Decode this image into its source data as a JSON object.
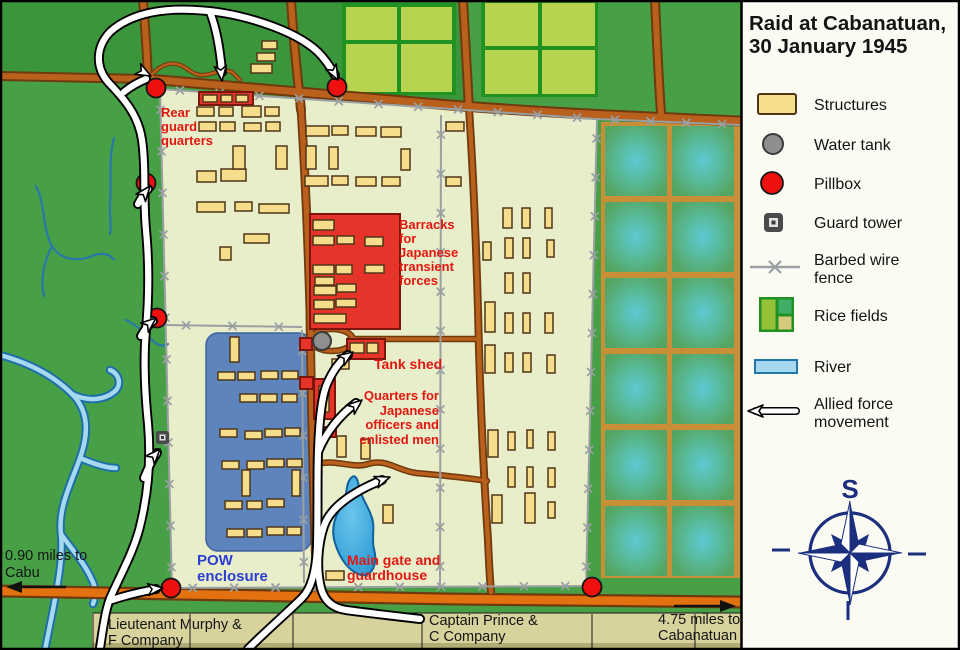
{
  "title": {
    "line1": "Raid at Cabanatuan,",
    "line2": "30 January 1945"
  },
  "legend": {
    "items": [
      {
        "id": "structures",
        "label": "Structures"
      },
      {
        "id": "water-tank",
        "label": "Water tank"
      },
      {
        "id": "pillbox",
        "label": "Pillbox"
      },
      {
        "id": "guard-tower",
        "label": "Guard tower"
      },
      {
        "id": "barbed-wire-fence",
        "label1": "Barbed wire",
        "label2": "fence"
      },
      {
        "id": "rice-fields",
        "label": "Rice fields"
      },
      {
        "id": "river",
        "label": "River"
      },
      {
        "id": "allied-force-movement",
        "label1": "Allied force",
        "label2": "movement"
      }
    ]
  },
  "compass": {
    "label": "S"
  },
  "map_labels": {
    "rear_guard": [
      "Rear",
      "guard",
      "quarters"
    ],
    "barracks": [
      "Barracks",
      "for",
      "Japanese",
      "transient",
      "forces"
    ],
    "tank_shed": "Tank shed",
    "quarters": [
      "Quarters for",
      "Japanese",
      "officers and",
      "enlisted men"
    ],
    "pow": [
      "POW",
      "enclosure"
    ],
    "main_gate": [
      "Main gate and",
      "guardhouse"
    ],
    "cabu": [
      "0.90 miles to",
      "Cabu"
    ],
    "murphy": [
      "Lieutenant Murphy &",
      "F Company"
    ],
    "prince": [
      "Captain Prince &",
      "C Company"
    ],
    "cabanatuan": [
      "4.75 miles to",
      "Cabanatuan"
    ]
  },
  "colors": {
    "land": "#47a046",
    "land_dark": "#3b963b",
    "camp": "#e8edca",
    "pow": "#5d84bc",
    "pow_dark": "#3f639c",
    "road": "#b8601c",
    "road_dark": "#6f3a0e",
    "road_bottom": "#e4710f",
    "structure": "#f6dd8b",
    "structure_border": "#4f3617",
    "red_building": "#e6342a",
    "pillbox": "#ee0f0f",
    "water_tank": "#8f8f8f",
    "fence": "#9aa0a2",
    "river": "#a6d9ef",
    "river_dark": "#1d6fa8",
    "stream": "#2878a8",
    "pond": "#2d9bd6",
    "pond_dark": "#10629f",
    "rice_cell": "#b7d450",
    "rice_border": "#1f9222",
    "paddy_line": "#c98f37",
    "paddy_green": "#55a562",
    "paddy_teal": "#5dc9d3",
    "band": "#d8d29c",
    "band_dark": "#b2ac74",
    "panel": "#fbfbf4",
    "text_red": "#e21711",
    "text_blue": "#2b3ed2",
    "ink": "#141414",
    "navy": "#1b2f7e"
  },
  "map_features": {
    "yellow_buildings": [
      [
        262,
        41,
        15,
        8
      ],
      [
        257,
        53,
        18,
        8
      ],
      [
        251,
        64,
        21,
        9
      ],
      [
        197,
        107,
        17,
        9
      ],
      [
        219,
        107,
        14,
        9
      ],
      [
        242,
        106,
        19,
        11
      ],
      [
        265,
        107,
        14,
        9
      ],
      [
        199,
        122,
        17,
        9
      ],
      [
        220,
        122,
        15,
        9
      ],
      [
        244,
        123,
        17,
        8
      ],
      [
        266,
        122,
        14,
        9
      ],
      [
        197,
        171,
        19,
        11
      ],
      [
        221,
        169,
        25,
        12
      ],
      [
        233,
        146,
        12,
        23
      ],
      [
        276,
        146,
        11,
        23
      ],
      [
        197,
        202,
        28,
        10
      ],
      [
        235,
        202,
        17,
        9
      ],
      [
        259,
        204,
        30,
        9
      ],
      [
        244,
        234,
        25,
        9
      ],
      [
        220,
        247,
        11,
        13
      ],
      [
        306,
        126,
        23,
        10
      ],
      [
        332,
        126,
        16,
        9
      ],
      [
        356,
        127,
        20,
        9
      ],
      [
        381,
        127,
        20,
        10
      ],
      [
        306,
        146,
        10,
        23
      ],
      [
        329,
        147,
        9,
        22
      ],
      [
        401,
        149,
        9,
        21
      ],
      [
        305,
        176,
        23,
        10
      ],
      [
        332,
        176,
        16,
        9
      ],
      [
        356,
        177,
        20,
        9
      ],
      [
        382,
        177,
        18,
        9
      ],
      [
        446,
        122,
        18,
        9
      ],
      [
        446,
        177,
        15,
        9
      ],
      [
        203,
        95,
        14,
        7
      ],
      [
        221,
        95,
        11,
        7
      ],
      [
        236,
        95,
        12,
        7
      ],
      [
        313,
        220,
        21,
        10
      ],
      [
        313,
        236,
        21,
        9
      ],
      [
        337,
        236,
        17,
        8
      ],
      [
        365,
        237,
        18,
        9
      ],
      [
        313,
        265,
        21,
        9
      ],
      [
        336,
        265,
        16,
        9
      ],
      [
        365,
        265,
        19,
        8
      ],
      [
        315,
        277,
        19,
        8
      ],
      [
        314,
        286,
        22,
        9
      ],
      [
        337,
        284,
        19,
        8
      ],
      [
        314,
        300,
        20,
        9
      ],
      [
        336,
        299,
        20,
        8
      ],
      [
        314,
        314,
        32,
        9
      ],
      [
        350,
        343,
        14,
        10
      ],
      [
        367,
        343,
        11,
        10
      ],
      [
        332,
        359,
        17,
        10
      ],
      [
        337,
        436,
        9,
        21
      ],
      [
        361,
        439,
        9,
        20
      ],
      [
        319,
        386,
        10,
        26
      ],
      [
        321,
        430,
        9,
        5
      ],
      [
        326,
        571,
        18,
        9
      ],
      [
        383,
        505,
        10,
        18
      ],
      [
        230,
        337,
        9,
        25
      ],
      [
        218,
        372,
        17,
        8
      ],
      [
        238,
        372,
        17,
        8
      ],
      [
        261,
        371,
        17,
        8
      ],
      [
        282,
        371,
        16,
        8
      ],
      [
        240,
        394,
        17,
        8
      ],
      [
        260,
        394,
        17,
        8
      ],
      [
        282,
        394,
        15,
        8
      ],
      [
        220,
        429,
        17,
        8
      ],
      [
        245,
        431,
        17,
        8
      ],
      [
        265,
        429,
        17,
        8
      ],
      [
        285,
        428,
        15,
        8
      ],
      [
        222,
        461,
        17,
        8
      ],
      [
        247,
        461,
        17,
        8
      ],
      [
        267,
        459,
        17,
        8
      ],
      [
        287,
        459,
        15,
        8
      ],
      [
        242,
        470,
        8,
        26
      ],
      [
        292,
        470,
        8,
        26
      ],
      [
        225,
        501,
        17,
        8
      ],
      [
        247,
        501,
        15,
        8
      ],
      [
        267,
        499,
        17,
        8
      ],
      [
        227,
        529,
        17,
        8
      ],
      [
        247,
        529,
        15,
        8
      ],
      [
        267,
        527,
        17,
        8
      ],
      [
        287,
        527,
        14,
        8
      ],
      [
        503,
        208,
        9,
        20
      ],
      [
        522,
        208,
        8,
        20
      ],
      [
        545,
        208,
        7,
        20
      ],
      [
        483,
        242,
        8,
        18
      ],
      [
        505,
        238,
        8,
        20
      ],
      [
        523,
        238,
        7,
        20
      ],
      [
        547,
        240,
        7,
        17
      ],
      [
        505,
        273,
        8,
        20
      ],
      [
        523,
        273,
        7,
        20
      ],
      [
        485,
        302,
        10,
        30
      ],
      [
        505,
        313,
        8,
        20
      ],
      [
        523,
        313,
        7,
        20
      ],
      [
        545,
        313,
        8,
        20
      ],
      [
        485,
        345,
        10,
        28
      ],
      [
        505,
        353,
        8,
        19
      ],
      [
        523,
        353,
        8,
        19
      ],
      [
        547,
        355,
        8,
        18
      ],
      [
        488,
        430,
        10,
        27
      ],
      [
        508,
        432,
        7,
        18
      ],
      [
        527,
        430,
        6,
        18
      ],
      [
        548,
        432,
        7,
        18
      ],
      [
        508,
        467,
        7,
        20
      ],
      [
        527,
        467,
        6,
        20
      ],
      [
        548,
        468,
        7,
        19
      ],
      [
        492,
        495,
        10,
        28
      ],
      [
        525,
        493,
        10,
        30
      ],
      [
        548,
        502,
        7,
        16
      ]
    ],
    "red_buildings": [
      [
        199,
        92,
        54,
        13
      ],
      [
        310,
        214,
        90,
        115
      ],
      [
        347,
        339,
        38,
        20
      ],
      [
        314,
        379,
        21,
        40
      ],
      [
        317,
        427,
        19,
        10
      ],
      [
        300,
        377,
        13,
        12
      ],
      [
        300,
        338,
        12,
        12
      ]
    ],
    "pillboxes": [
      [
        156,
        88
      ],
      [
        337,
        87
      ],
      [
        146,
        183
      ],
      [
        157,
        318
      ],
      [
        171,
        588
      ],
      [
        592,
        587
      ]
    ],
    "fence_segments": [
      [
        160,
        89,
        597,
        119
      ],
      [
        597,
        119,
        740,
        125
      ],
      [
        160,
        89,
        172,
        588
      ],
      [
        597,
        119,
        586,
        586
      ],
      [
        172,
        588,
        586,
        586
      ],
      [
        441,
        115,
        440,
        586
      ],
      [
        163,
        325,
        302,
        327
      ],
      [
        302,
        330,
        304,
        583
      ]
    ],
    "rice_cells": [
      [
        346,
        7,
        51,
        33
      ],
      [
        401,
        7,
        51,
        33
      ],
      [
        346,
        44,
        51,
        48
      ],
      [
        401,
        44,
        51,
        48
      ],
      [
        485,
        3,
        53,
        43
      ],
      [
        542,
        3,
        53,
        43
      ],
      [
        485,
        50,
        53,
        44
      ],
      [
        542,
        50,
        53,
        44
      ]
    ],
    "paddy_cells": [
      [
        605,
        126,
        62,
        70
      ],
      [
        672,
        126,
        62,
        70
      ],
      [
        605,
        202,
        62,
        70
      ],
      [
        672,
        202,
        62,
        70
      ],
      [
        605,
        278,
        62,
        70
      ],
      [
        672,
        278,
        62,
        70
      ],
      [
        605,
        354,
        62,
        70
      ],
      [
        672,
        354,
        62,
        70
      ],
      [
        605,
        430,
        62,
        70
      ],
      [
        672,
        430,
        62,
        70
      ],
      [
        605,
        506,
        62,
        70
      ],
      [
        672,
        506,
        62,
        70
      ]
    ],
    "band_lines": [
      93,
      190,
      293,
      422,
      592,
      695
    ]
  }
}
